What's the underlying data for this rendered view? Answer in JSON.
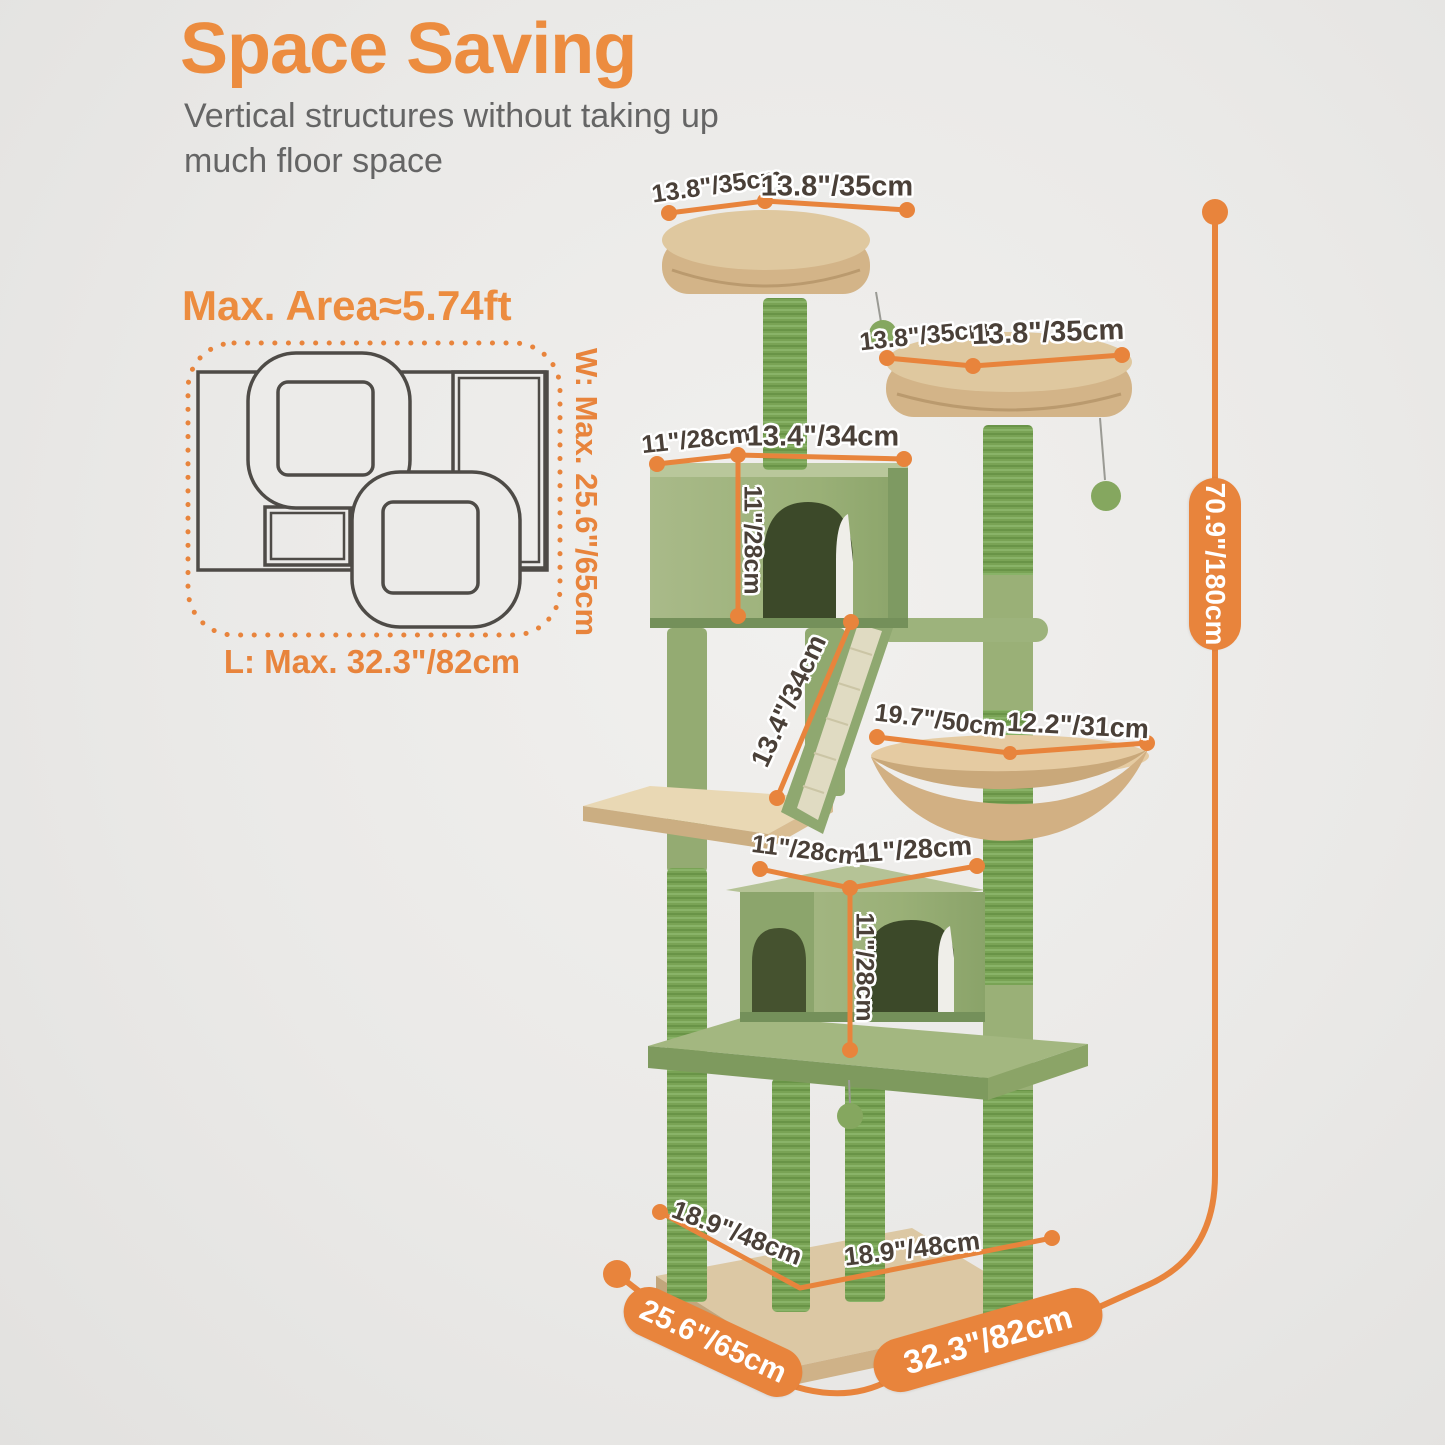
{
  "page": {
    "bg": "#EAE9E7",
    "accent": "#E8843C",
    "text_dark": "#4A4038"
  },
  "header": {
    "title": "Space Saving",
    "subtitle": "Vertical structures without taking up\nmuch floor space"
  },
  "area_diagram": {
    "heading": "Max. Area≈5.74ft",
    "width_label": "W: Max. 25.6\"/65cm",
    "length_label": "L: Max. 32.3\"/82cm"
  },
  "dimensions": {
    "top_platform_left": "13.8\"/35cm",
    "top_platform_right": "13.8\"/35cm",
    "second_platform_left": "13.8\"/35cm",
    "second_platform_right": "13.8\"/35cm",
    "upper_condo_depth": "11\"/28cm",
    "upper_condo_width": "13.4\"/34cm",
    "upper_condo_height": "11\"/28cm",
    "ramp_length": "13.4\"/34cm",
    "hammock_width": "19.7\"/50cm",
    "hammock_depth": "12.2\"/31cm",
    "lower_condo_depth": "11\"/28cm",
    "lower_condo_width": "11\"/28cm",
    "lower_condo_height": "11\"/28cm",
    "base_depth": "18.9\"/48cm",
    "base_width": "18.9\"/48cm",
    "overall_height": "70.9\"/180cm",
    "overall_depth": "25.6\"/65cm",
    "overall_width": "32.3\"/82cm"
  }
}
